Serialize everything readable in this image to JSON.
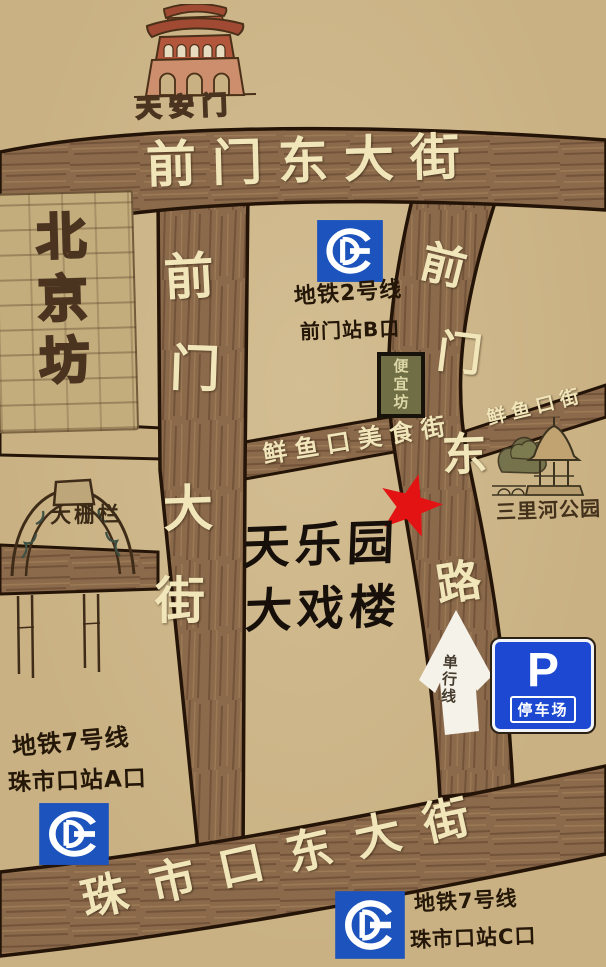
{
  "map": {
    "landmarks": {
      "tiananmen": {
        "label": "天安门"
      },
      "beijingfang": {
        "label": "北京坊"
      },
      "dashilan": {
        "label": "大栅栏"
      },
      "bianyifang": {
        "label": "便宜坊"
      },
      "sanlihe_park": {
        "label": "三里河公园"
      },
      "theater": {
        "line1": "天乐园",
        "line2": "大戏楼"
      }
    },
    "streets": {
      "qianmen_east_street": {
        "name": "前门东大街"
      },
      "qianmen_street": {
        "name": "前门大街",
        "chars": [
          "前",
          "门",
          "大",
          "街"
        ]
      },
      "qianmen_east_road": {
        "name": "前门东路",
        "chars": [
          "前",
          "门",
          "东",
          "路"
        ]
      },
      "xianyukou_food_street": {
        "name": "鲜鱼口美食街"
      },
      "xianyukou_street": {
        "name": "鲜鱼口街"
      },
      "zhushikou_east_street": {
        "name": "珠市口东大街"
      }
    },
    "metro": {
      "qianmen_station": {
        "line": "地铁2号线",
        "exit": "前门站B口"
      },
      "zhushikou_station_a": {
        "line": "地铁7号线",
        "exit": "珠市口站A口"
      },
      "zhushikou_station_c": {
        "line": "地铁7号线",
        "exit": "珠市口站C口"
      }
    },
    "signs": {
      "parking": {
        "symbol": "P",
        "label": "停车场"
      },
      "one_way": {
        "label": "单行线"
      }
    },
    "colors": {
      "background": "#c9b183",
      "road": "#8b6a4b",
      "road_outline": "#241407",
      "street_text": "#f1e5ba",
      "ink": "#241708",
      "metro_blue": "#1d53bc",
      "parking_blue": "#1d49d2",
      "star_red": "#e41313",
      "arrow_white": "#f5f2ea"
    }
  }
}
